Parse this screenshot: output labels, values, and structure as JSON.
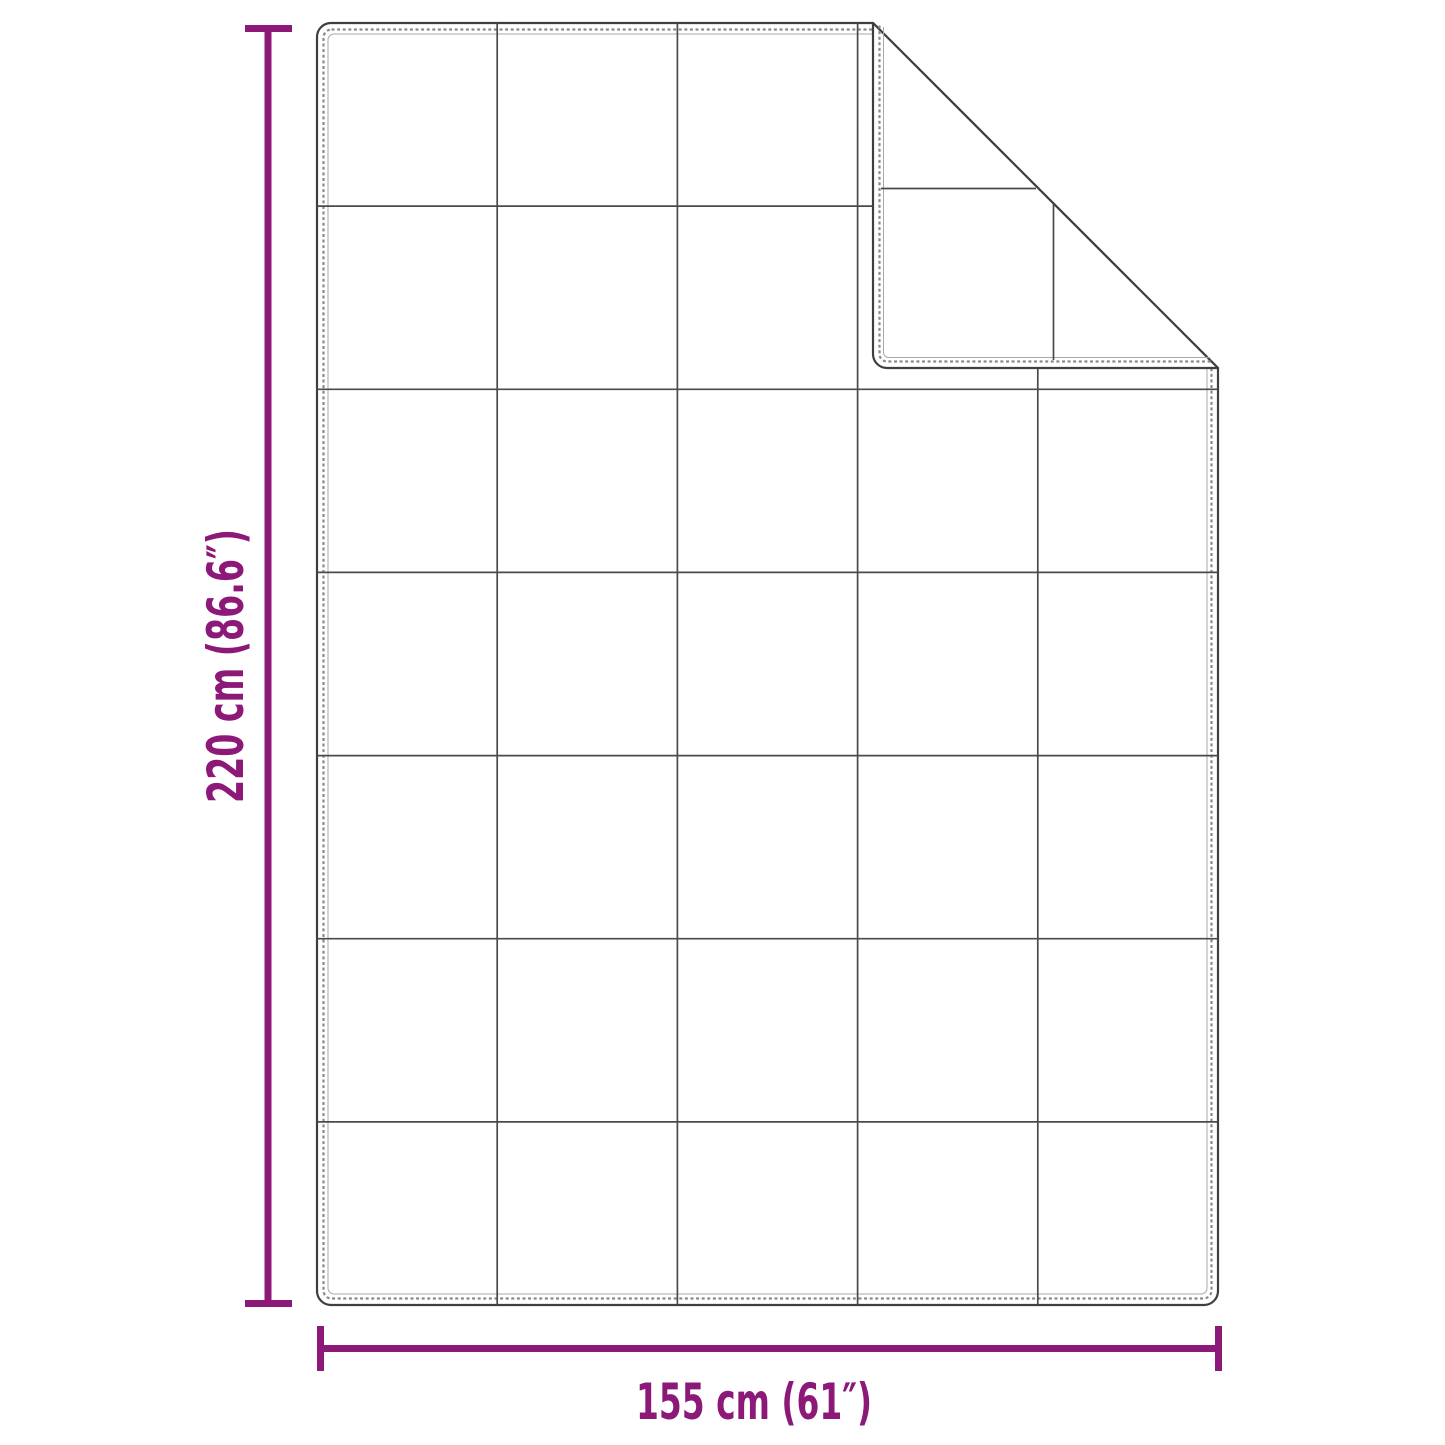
{
  "page": {
    "background": "#ffffff",
    "kind": "product-dimension-diagram",
    "subject": "quilted blanket with folded top-right corner"
  },
  "diagram": {
    "grid": {
      "columns": 5,
      "rows": 7
    },
    "outline_color": "#3f3f3f",
    "grid_line_color": "#4a4a4a",
    "stitch_color": "#8a8a8a",
    "seam_color": "#a8a8a8",
    "accent_color": "#8C1878",
    "height_dimension": {
      "label": "220 cm (86.6″)"
    },
    "width_dimension": {
      "label": "155 cm (61″)"
    }
  }
}
